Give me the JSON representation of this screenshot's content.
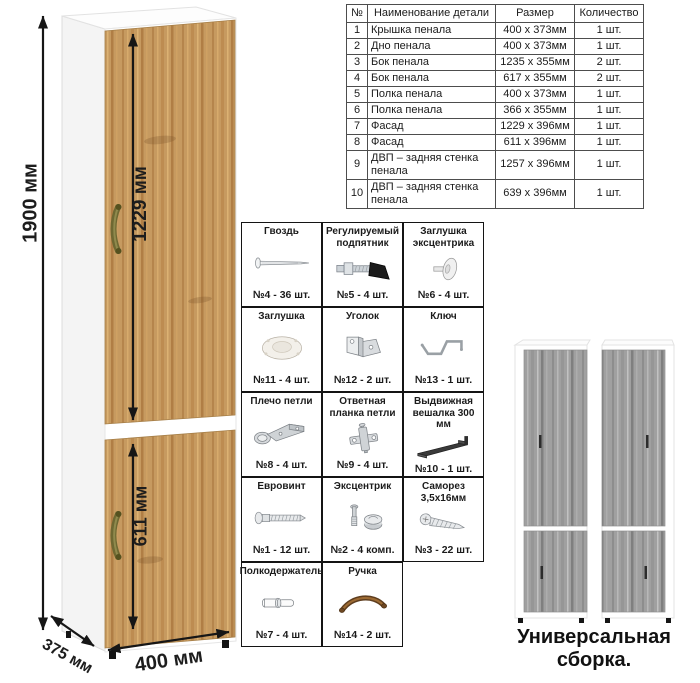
{
  "cabinet": {
    "dimensions": {
      "height": "1900 мм",
      "upper_door": "1229 мм",
      "lower_door": "611 мм",
      "width": "400 мм",
      "depth": "375 мм"
    },
    "colors": {
      "door_wood": "#c69a60",
      "carcass": "#ffffff",
      "handle": "#6e6832"
    }
  },
  "parts_table": {
    "headers": [
      "№",
      "Наименование детали",
      "Размер",
      "Количество"
    ],
    "rows": [
      [
        "1",
        "Крышка пенала",
        "400 х 373мм",
        "1 шт."
      ],
      [
        "2",
        "Дно пенала",
        "400 х 373мм",
        "1 шт."
      ],
      [
        "3",
        "Бок пенала",
        "1235 х 355мм",
        "2 шт."
      ],
      [
        "4",
        "Бок пенала",
        "617 х 355мм",
        "2 шт."
      ],
      [
        "5",
        "Полка пенала",
        "400 х 373мм",
        "1 шт."
      ],
      [
        "6",
        "Полка пенала",
        "366 х 355мм",
        "1 шт."
      ],
      [
        "7",
        "Фасад",
        "1229 х 396мм",
        "1 шт."
      ],
      [
        "8",
        "Фасад",
        "611 х 396мм",
        "1 шт."
      ],
      [
        "9",
        "ДВП – задняя стенка пенала",
        "1257 х 396мм",
        "1 шт."
      ],
      [
        "10",
        "ДВП – задняя стенка пенала",
        "639 х 396мм",
        "1 шт."
      ]
    ]
  },
  "hardware": {
    "items": [
      {
        "title": "Гвоздь",
        "count": "№4 - 36 шт.",
        "icon": "nail-icon"
      },
      {
        "title": "Регулируемый подпятник",
        "count": "№5 - 4 шт.",
        "icon": "adjustable-foot-icon"
      },
      {
        "title": "Заглушка эксцентрика",
        "count": "№6 - 4 шт.",
        "icon": "cam-cap-icon"
      },
      {
        "title": "Заглушка",
        "count": "№11 - 4 шт.",
        "icon": "cap-icon"
      },
      {
        "title": "Уголок",
        "count": "№12 - 2 шт.",
        "icon": "corner-bracket-icon"
      },
      {
        "title": "Ключ",
        "count": "№13 - 1 шт.",
        "icon": "hex-key-icon"
      },
      {
        "title": "Плечо петли",
        "count": "№8 - 4 шт.",
        "icon": "hinge-arm-icon"
      },
      {
        "title": "Ответная планка петли",
        "count": "№9 - 4 шт.",
        "icon": "hinge-plate-icon"
      },
      {
        "title": "Выдвижная вешалка 300 мм",
        "count": "№10 - 1 шт.",
        "icon": "pullout-hanger-icon"
      },
      {
        "title": "Евровинт",
        "count": "№1 - 12 шт.",
        "icon": "confirmat-screw-icon"
      },
      {
        "title": "Эксцентрик",
        "count": "№2 - 4 комп.",
        "icon": "eccentric-cam-icon"
      },
      {
        "title": "Саморез 3,5х16мм",
        "count": "№3 - 22 шт.",
        "icon": "self-tapping-screw-icon"
      },
      {
        "title": "Полкодержатель",
        "count": "№7 - 4 шт.",
        "icon": "shelf-pin-icon"
      },
      {
        "title": "Ручка",
        "count": "№14 - 2 шт.",
        "icon": "handle-icon"
      }
    ]
  },
  "assembled": {
    "caption": "Универсальная сборка.",
    "colors": {
      "door_wood": "#a0a0a0",
      "carcass": "#ffffff"
    }
  }
}
